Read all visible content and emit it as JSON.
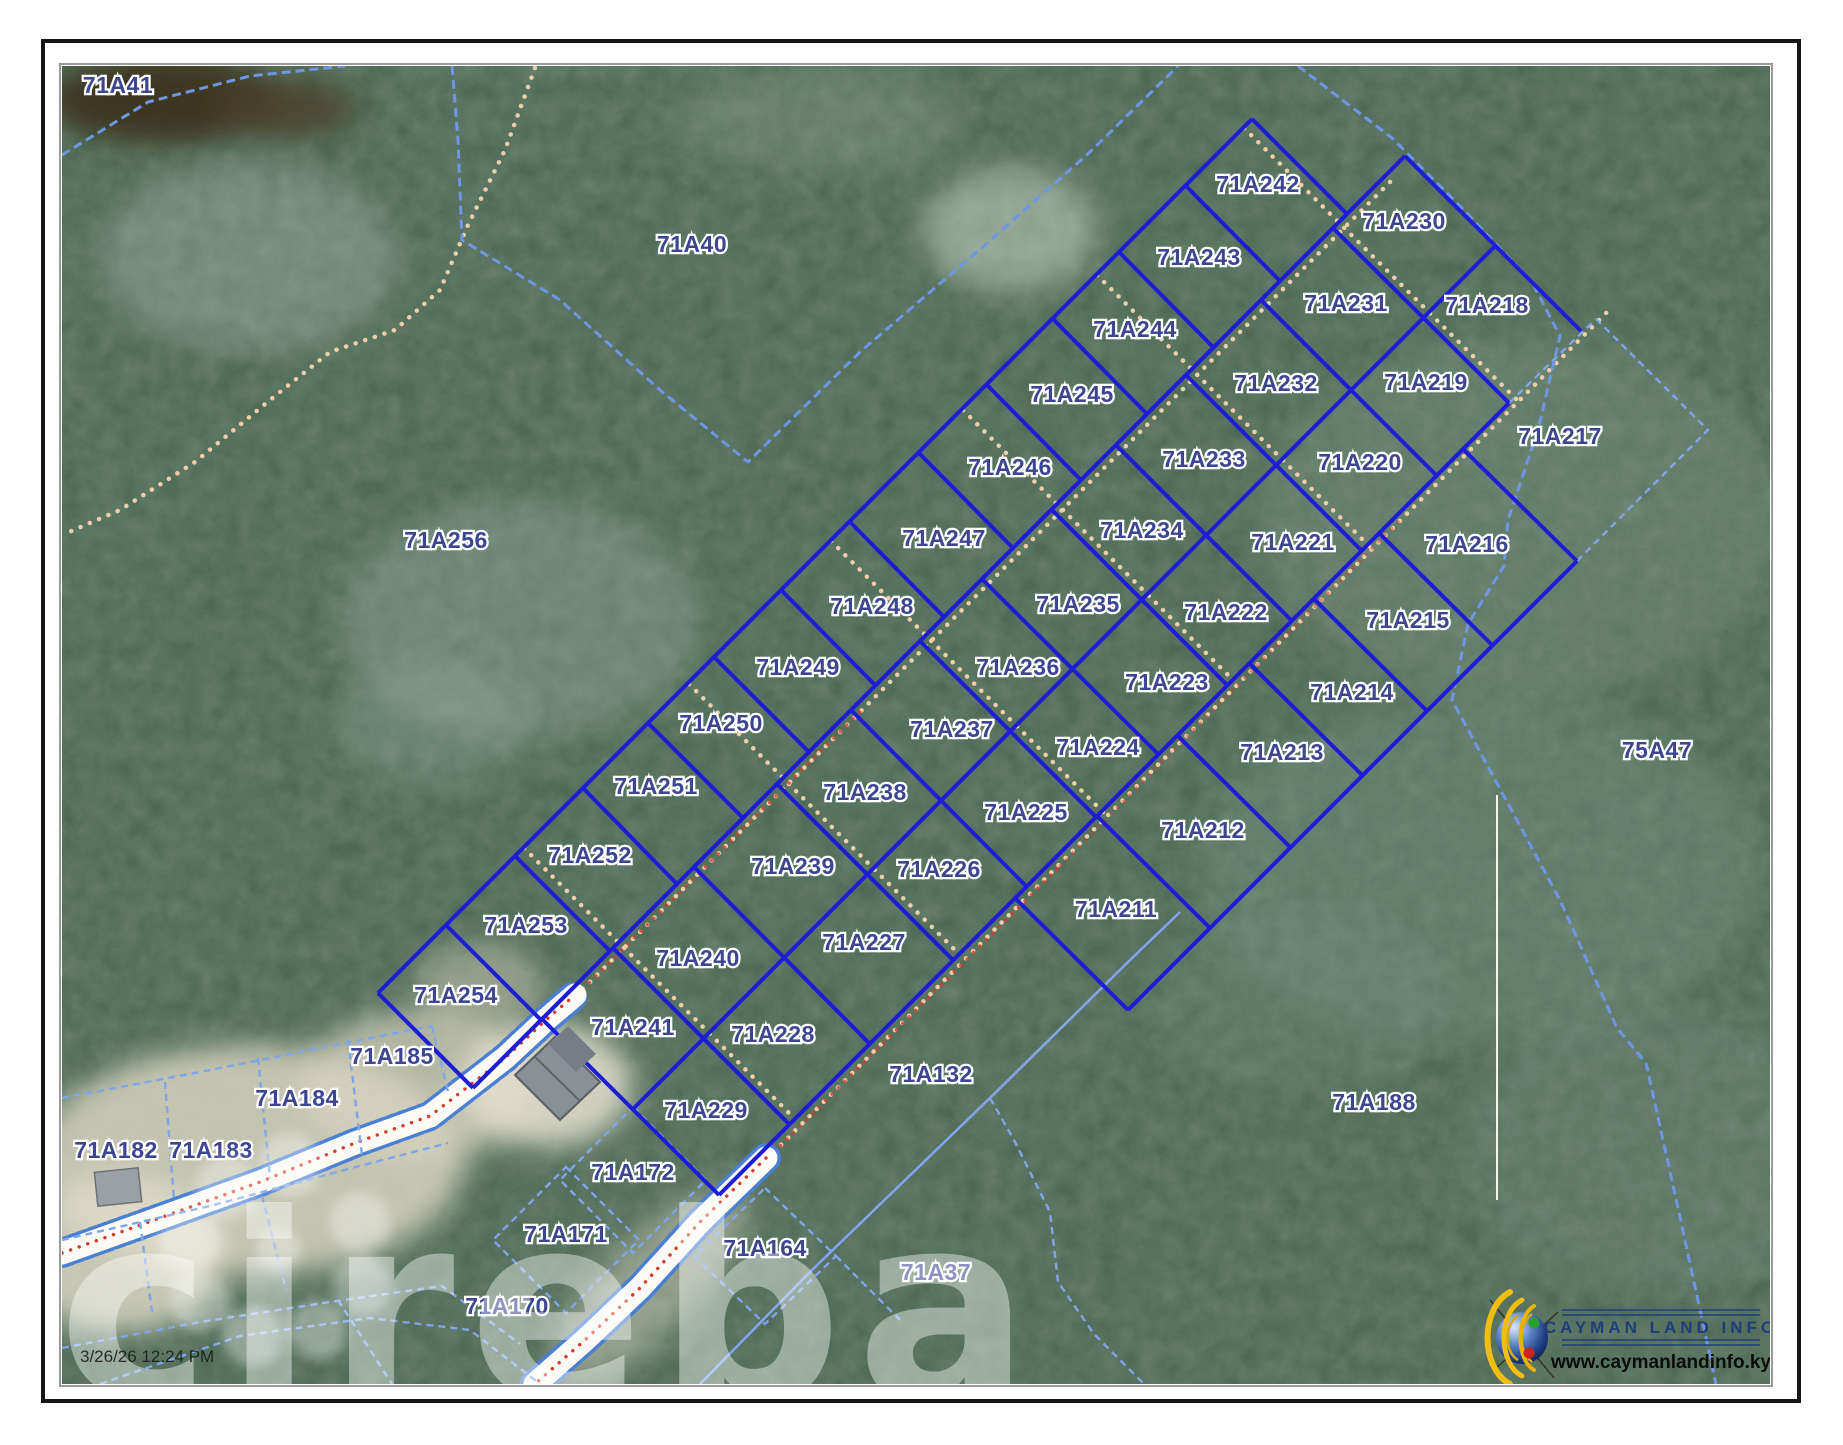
{
  "page": {
    "timestamp": "3/26/26 12:24 PM",
    "watermark": "cireba"
  },
  "logo": {
    "name": "CAYMAN LAND INFO",
    "website": "www.caymanlandinfo.ky"
  },
  "colors": {
    "lot_boundary": "#1d1dd8",
    "block_boundary": "#6d97e3",
    "parcel_label": "#3d4490",
    "road_centerline": "#d83a2e",
    "track_dots": "#f0cdaa"
  },
  "map": {
    "parcels": [
      {
        "id": "71A41",
        "x": 118,
        "y": 93
      },
      {
        "id": "71A40",
        "x": 692,
        "y": 252
      },
      {
        "id": "71A256",
        "x": 446,
        "y": 548
      },
      {
        "id": "75A47",
        "x": 1657,
        "y": 758
      },
      {
        "id": "71A188",
        "x": 1374,
        "y": 1110
      },
      {
        "id": "71A132",
        "x": 931,
        "y": 1082
      },
      {
        "id": "71A37",
        "x": 936,
        "y": 1280
      },
      {
        "id": "71A185",
        "x": 392,
        "y": 1064
      },
      {
        "id": "71A184",
        "x": 297,
        "y": 1106
      },
      {
        "id": "71A183",
        "x": 211,
        "y": 1158
      },
      {
        "id": "71A182",
        "x": 116,
        "y": 1158
      },
      {
        "id": "71A172",
        "x": 633,
        "y": 1180
      },
      {
        "id": "71A171",
        "x": 566,
        "y": 1242
      },
      {
        "id": "71A170",
        "x": 507,
        "y": 1314
      },
      {
        "id": "71A164",
        "x": 765,
        "y": 1256
      },
      {
        "id": "71A254",
        "x": 456,
        "y": 1003
      },
      {
        "id": "71A253",
        "x": 526,
        "y": 933
      },
      {
        "id": "71A252",
        "x": 590,
        "y": 863
      },
      {
        "id": "71A251",
        "x": 656,
        "y": 794
      },
      {
        "id": "71A250",
        "x": 721,
        "y": 731
      },
      {
        "id": "71A249",
        "x": 798,
        "y": 675
      },
      {
        "id": "71A248",
        "x": 872,
        "y": 614
      },
      {
        "id": "71A247",
        "x": 944,
        "y": 546
      },
      {
        "id": "71A246",
        "x": 1010,
        "y": 475
      },
      {
        "id": "71A245",
        "x": 1072,
        "y": 402
      },
      {
        "id": "71A244",
        "x": 1135,
        "y": 337
      },
      {
        "id": "71A243",
        "x": 1199,
        "y": 265
      },
      {
        "id": "71A242",
        "x": 1258,
        "y": 192
      },
      {
        "id": "71A241",
        "x": 633,
        "y": 1035
      },
      {
        "id": "71A240",
        "x": 698,
        "y": 966
      },
      {
        "id": "71A239",
        "x": 793,
        "y": 874
      },
      {
        "id": "71A238",
        "x": 865,
        "y": 800
      },
      {
        "id": "71A237",
        "x": 952,
        "y": 737
      },
      {
        "id": "71A236",
        "x": 1018,
        "y": 675
      },
      {
        "id": "71A235",
        "x": 1078,
        "y": 612
      },
      {
        "id": "71A234",
        "x": 1142,
        "y": 538
      },
      {
        "id": "71A233",
        "x": 1204,
        "y": 467
      },
      {
        "id": "71A232",
        "x": 1276,
        "y": 391
      },
      {
        "id": "71A231",
        "x": 1346,
        "y": 311
      },
      {
        "id": "71A230",
        "x": 1404,
        "y": 229
      },
      {
        "id": "71A229",
        "x": 706,
        "y": 1118
      },
      {
        "id": "71A228",
        "x": 773,
        "y": 1042
      },
      {
        "id": "71A227",
        "x": 864,
        "y": 950
      },
      {
        "id": "71A226",
        "x": 939,
        "y": 877
      },
      {
        "id": "71A225",
        "x": 1026,
        "y": 820
      },
      {
        "id": "71A224",
        "x": 1098,
        "y": 755
      },
      {
        "id": "71A223",
        "x": 1167,
        "y": 690
      },
      {
        "id": "71A222",
        "x": 1226,
        "y": 620
      },
      {
        "id": "71A221",
        "x": 1293,
        "y": 550
      },
      {
        "id": "71A220",
        "x": 1360,
        "y": 470
      },
      {
        "id": "71A219",
        "x": 1426,
        "y": 390
      },
      {
        "id": "71A218",
        "x": 1487,
        "y": 313
      },
      {
        "id": "71A217",
        "x": 1560,
        "y": 444
      },
      {
        "id": "71A216",
        "x": 1467,
        "y": 552
      },
      {
        "id": "71A215",
        "x": 1408,
        "y": 628
      },
      {
        "id": "71A214",
        "x": 1352,
        "y": 700
      },
      {
        "id": "71A213",
        "x": 1282,
        "y": 760
      },
      {
        "id": "71A212",
        "x": 1203,
        "y": 838
      },
      {
        "id": "71A211",
        "x": 1116,
        "y": 917
      }
    ]
  }
}
